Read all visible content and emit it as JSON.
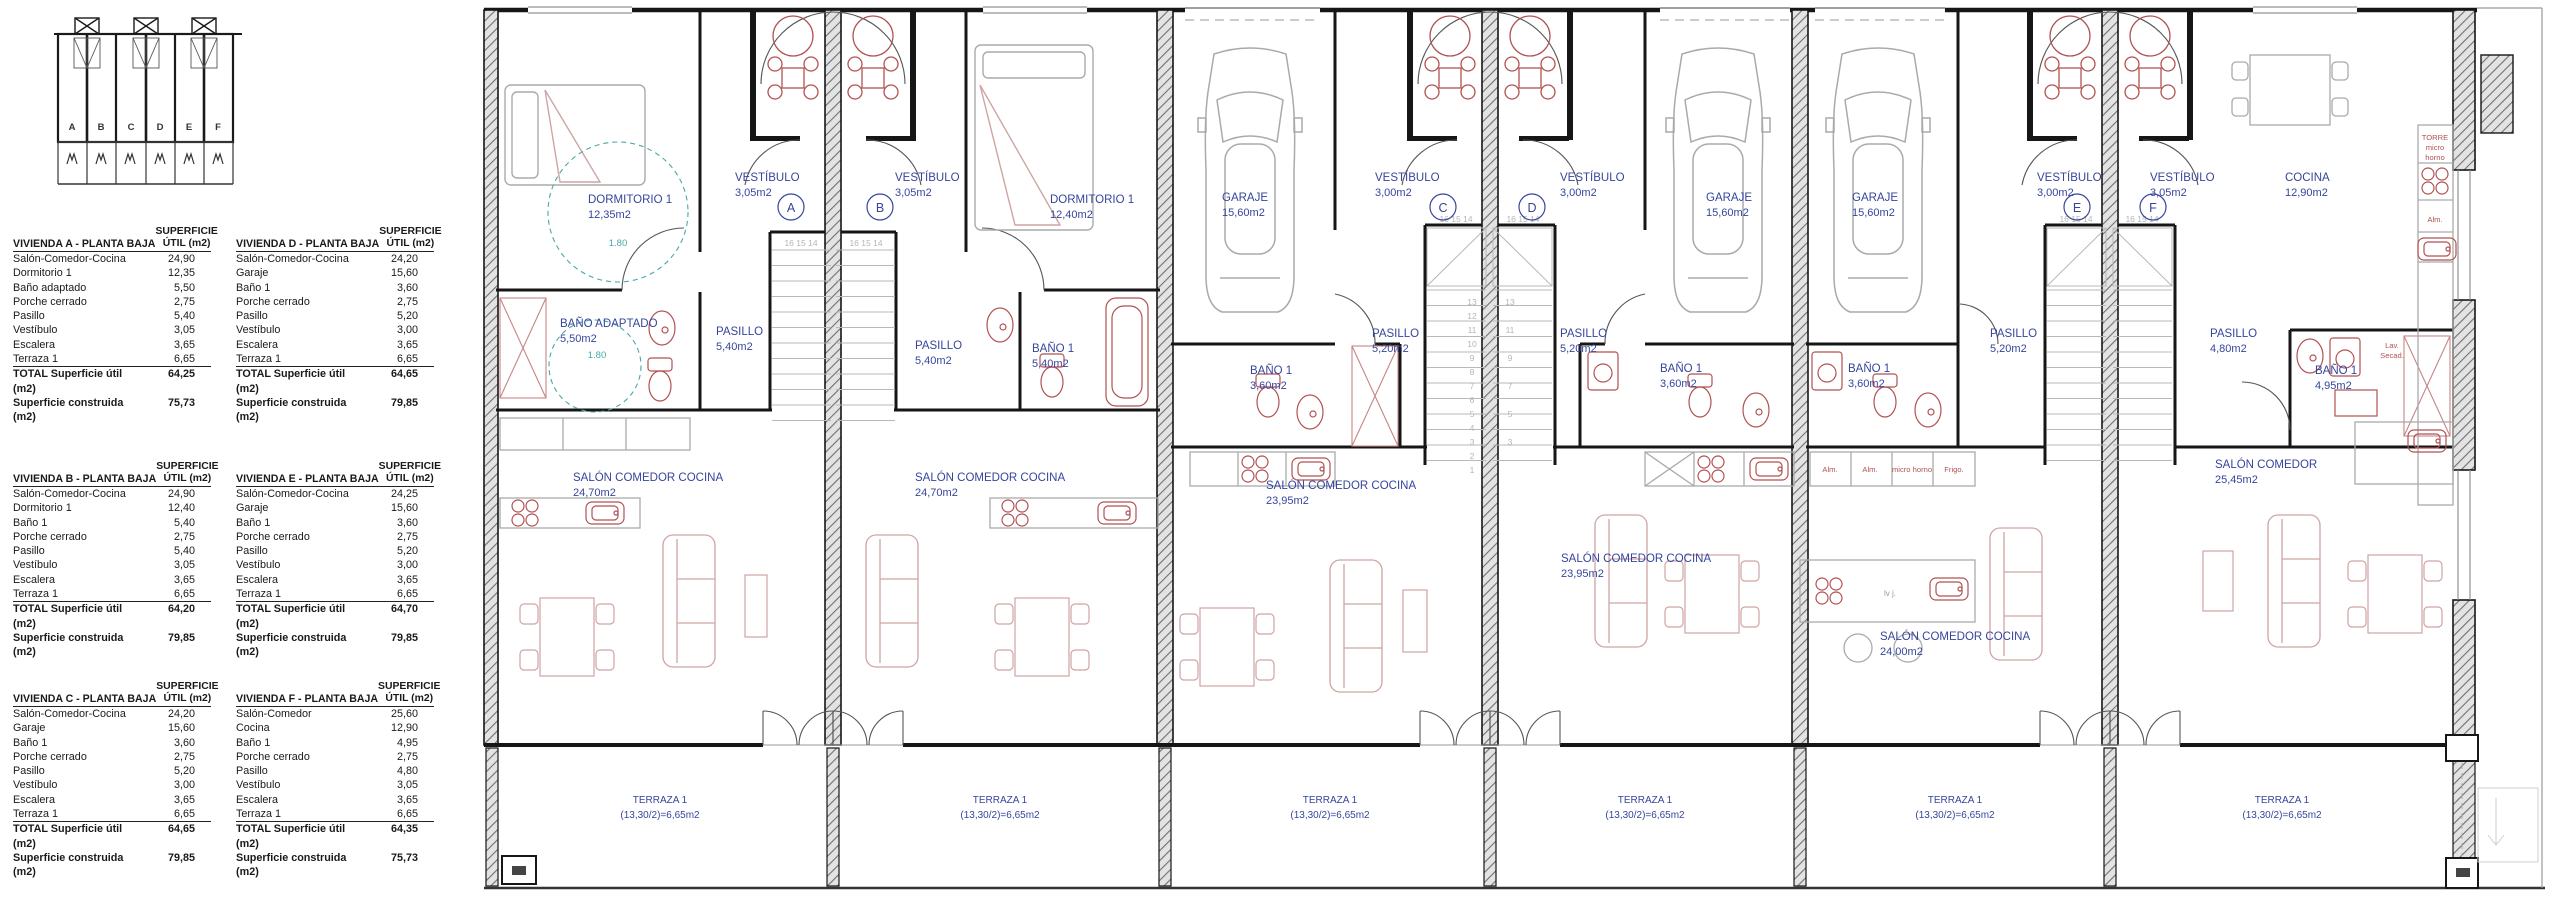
{
  "key_plan": {
    "letters": [
      "A",
      "B",
      "C",
      "D",
      "E",
      "F"
    ]
  },
  "tables": [
    {
      "title": "VIVIENDA A - PLANTA BAJA",
      "col_header": [
        "SUPERFICIE",
        "ÚTIL (m2)"
      ],
      "rows": [
        [
          "Salón-Comedor-Cocina",
          "24,90"
        ],
        [
          "Dormitorio 1",
          "12,35"
        ],
        [
          "Baño adaptado",
          "5,50"
        ],
        [
          "Porche cerrado",
          "2,75"
        ],
        [
          "Pasillo",
          "5,40"
        ],
        [
          "Vestíbulo",
          "3,05"
        ],
        [
          "Escalera",
          "3,65"
        ],
        [
          "Terraza 1",
          "6,65"
        ]
      ],
      "total_label": "TOTAL Superficie útil (m2)",
      "total_value": "64,25",
      "built_label": "Superficie construida (m2)",
      "built_value": "75,73"
    },
    {
      "title": "VIVIENDA B - PLANTA BAJA",
      "col_header": [
        "SUPERFICIE",
        "ÚTIL (m2)"
      ],
      "rows": [
        [
          "Salón-Comedor-Cocina",
          "24,90"
        ],
        [
          "Dormitorio 1",
          "12,40"
        ],
        [
          "Baño 1",
          "5,40"
        ],
        [
          "Porche cerrado",
          "2,75"
        ],
        [
          "Pasillo",
          "5,40"
        ],
        [
          "Vestíbulo",
          "3,05"
        ],
        [
          "Escalera",
          "3,65"
        ],
        [
          "Terraza 1",
          "6,65"
        ]
      ],
      "total_label": "TOTAL Superficie útil (m2)",
      "total_value": "64,20",
      "built_label": "Superficie construida (m2)",
      "built_value": "79,85"
    },
    {
      "title": "VIVIENDA C - PLANTA BAJA",
      "col_header": [
        "SUPERFICIE",
        "ÚTIL (m2)"
      ],
      "rows": [
        [
          "Salón-Comedor-Cocina",
          "24,20"
        ],
        [
          "Garaje",
          "15,60"
        ],
        [
          "Baño 1",
          "3,60"
        ],
        [
          "Porche cerrado",
          "2,75"
        ],
        [
          "Pasillo",
          "5,20"
        ],
        [
          "Vestíbulo",
          "3,00"
        ],
        [
          "Escalera",
          "3,65"
        ],
        [
          "Terraza 1",
          "6,65"
        ]
      ],
      "total_label": "TOTAL Superficie útil (m2)",
      "total_value": "64,65",
      "built_label": "Superficie construida (m2)",
      "built_value": "79,85"
    },
    {
      "title": "VIVIENDA D - PLANTA BAJA",
      "col_header": [
        "SUPERFICIE",
        "ÚTIL (m2)"
      ],
      "rows": [
        [
          "Salón-Comedor-Cocina",
          "24,20"
        ],
        [
          "Garaje",
          "15,60"
        ],
        [
          "Baño 1",
          "3,60"
        ],
        [
          "Porche cerrado",
          "2,75"
        ],
        [
          "Pasillo",
          "5,20"
        ],
        [
          "Vestíbulo",
          "3,00"
        ],
        [
          "Escalera",
          "3,65"
        ],
        [
          "Terraza 1",
          "6,65"
        ]
      ],
      "total_label": "TOTAL Superficie útil (m2)",
      "total_value": "64,65",
      "built_label": "Superficie construida (m2)",
      "built_value": "79,85"
    },
    {
      "title": "VIVIENDA E - PLANTA BAJA",
      "col_header": [
        "SUPERFICIE",
        "ÚTIL (m2)"
      ],
      "rows": [
        [
          "Salón-Comedor-Cocina",
          "24,25"
        ],
        [
          "Garaje",
          "15,60"
        ],
        [
          "Baño 1",
          "3,60"
        ],
        [
          "Porche cerrado",
          "2,75"
        ],
        [
          "Pasillo",
          "5,20"
        ],
        [
          "Vestíbulo",
          "3,00"
        ],
        [
          "Escalera",
          "3,65"
        ],
        [
          "Terraza 1",
          "6,65"
        ]
      ],
      "total_label": "TOTAL Superficie útil (m2)",
      "total_value": "64,70",
      "built_label": "Superficie construida (m2)",
      "built_value": "79,85"
    },
    {
      "title": "VIVIENDA F - PLANTA BAJA",
      "col_header": [
        "SUPERFICIE",
        "ÚTIL (m2)"
      ],
      "rows": [
        [
          "Salón-Comedor",
          "25,60"
        ],
        [
          "Cocina",
          "12,90"
        ],
        [
          "Baño 1",
          "4,95"
        ],
        [
          "Porche cerrado",
          "2,75"
        ],
        [
          "Pasillo",
          "4,80"
        ],
        [
          "Vestíbulo",
          "3,05"
        ],
        [
          "Escalera",
          "3,65"
        ],
        [
          "Terraza 1",
          "6,65"
        ]
      ],
      "total_label": "TOTAL Superficie útil (m2)",
      "total_value": "64,35",
      "built_label": "Superficie construida (m2)",
      "built_value": "75,73"
    }
  ],
  "plan": {
    "units": [
      {
        "letter": "A",
        "vest_name": "VESTÍBULO",
        "vest_area": "3,05m2",
        "room2_name": "DORMITORIO 1",
        "room2_area": "12,35m2",
        "bano_name": "BAÑO ADAPTADO",
        "bano_area": "5,50m2",
        "pasillo_name": "PASILLO",
        "pasillo_area": "5,40m2",
        "salon_name": "SALÓN COMEDOR COCINA",
        "salon_area": "24,70m2",
        "terraza_name": "TERRAZA 1",
        "terraza_area": "(13,30/2)=6,65m2"
      },
      {
        "letter": "B",
        "vest_name": "VESTÍBULO",
        "vest_area": "3,05m2",
        "room2_name": "DORMITORIO 1",
        "room2_area": "12,40m2",
        "bano_name": "BAÑO 1",
        "bano_area": "5,40m2",
        "pasillo_name": "PASILLO",
        "pasillo_area": "5,40m2",
        "salon_name": "SALÓN COMEDOR COCINA",
        "salon_area": "24,70m2",
        "terraza_name": "TERRAZA 1",
        "terraza_area": "(13,30/2)=6,65m2"
      },
      {
        "letter": "C",
        "vest_name": "VESTÍBULO",
        "vest_area": "3,00m2",
        "room2_name": "GARAJE",
        "room2_area": "15,60m2",
        "bano_name": "BAÑO 1",
        "bano_area": "3,60m2",
        "pasillo_name": "PASILLO",
        "pasillo_area": "5,20m2",
        "salon_name": "SALÓN COMEDOR COCINA",
        "salon_area": "23,95m2",
        "terraza_name": "TERRAZA 1",
        "terraza_area": "(13,30/2)=6,65m2"
      },
      {
        "letter": "D",
        "vest_name": "VESTÍBULO",
        "vest_area": "3,00m2",
        "room2_name": "GARAJE",
        "room2_area": "15,60m2",
        "bano_name": "BAÑO 1",
        "bano_area": "3,60m2",
        "pasillo_name": "PASILLO",
        "pasillo_area": "5,20m2",
        "salon_name": "SALÓN COMEDOR COCINA",
        "salon_area": "23,95m2",
        "terraza_name": "TERRAZA 1",
        "terraza_area": "(13,30/2)=6,65m2"
      },
      {
        "letter": "E",
        "vest_name": "VESTÍBULO",
        "vest_area": "3,00m2",
        "room2_name": "GARAJE",
        "room2_area": "15,60m2",
        "bano_name": "BAÑO 1",
        "bano_area": "3,60m2",
        "pasillo_name": "PASILLO",
        "pasillo_area": "5,20m2",
        "salon_name": "SALÓN COMEDOR COCINA",
        "salon_area": "24,00m2",
        "terraza_name": "TERRAZA 1",
        "terraza_area": "(13,30/2)=6,65m2"
      },
      {
        "letter": "F",
        "vest_name": "VESTÍBULO",
        "vest_area": "3,05m2",
        "room2_name": "COCINA",
        "room2_area": "12,90m2",
        "bano_name": "BAÑO 1",
        "bano_area": "4,95m2",
        "pasillo_name": "PASILLO",
        "pasillo_area": "4,80m2",
        "salon_name": "SALÓN COMEDOR",
        "salon_area": "25,45m2",
        "terraza_name": "TERRAZA 1",
        "terraza_area": "(13,30/2)=6,65m2"
      }
    ],
    "stair_top": "16 15 14",
    "stair_run": [
      "13",
      "12",
      "11",
      "10",
      "9",
      "8",
      "7",
      "6",
      "5",
      "4",
      "3",
      "2",
      "1"
    ],
    "dim": "1.80",
    "appliances": {
      "alm": "Alm.",
      "micro_horno": "micro horno",
      "frigo": "Frigo.",
      "lvj": "lv j.",
      "torre": "TORRE",
      "micro": "micro",
      "horno": "horno",
      "lav": "Lav.",
      "secad": "Secad."
    }
  }
}
